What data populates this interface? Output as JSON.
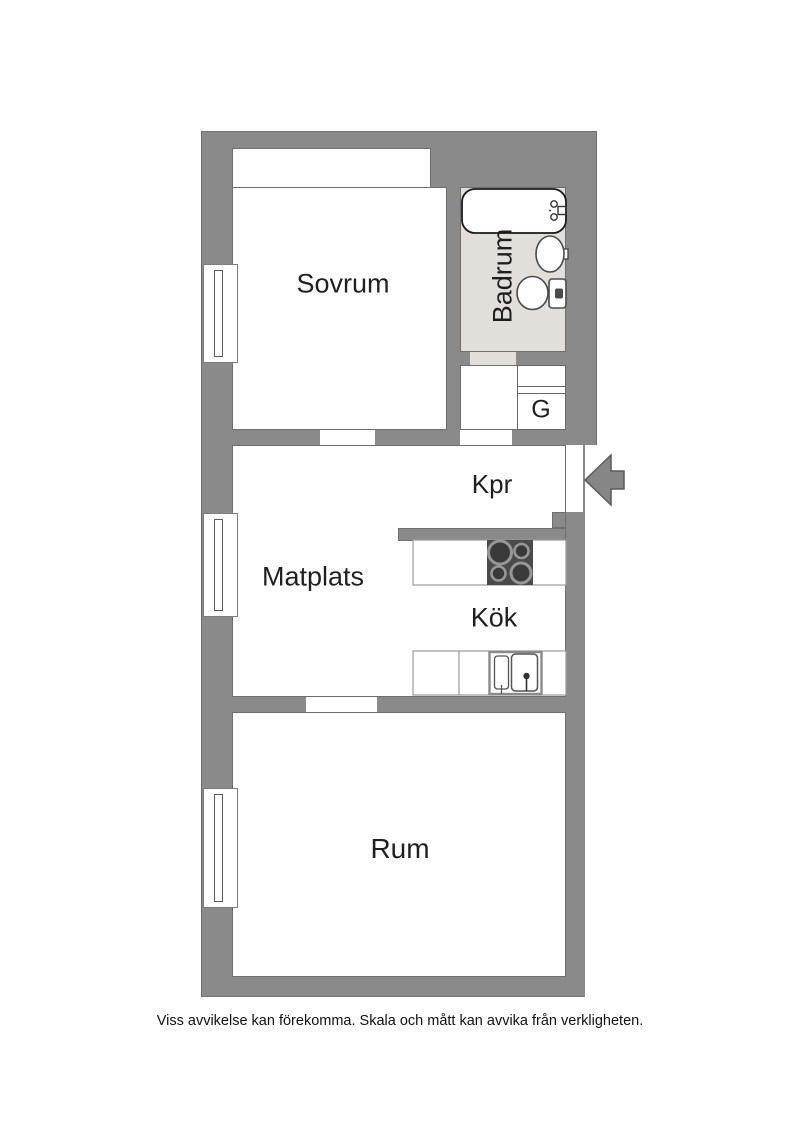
{
  "labels": {
    "sovrum": "Sovrum",
    "badrum": "Badrum",
    "garderob": "G",
    "kpr": "Kpr",
    "matplats": "Matplats",
    "kok": "Kök",
    "rum": "Rum"
  },
  "caption": "Viss avvikelse kan förekomma. Skala och mått kan avvika från verkligheten.",
  "colors": {
    "wall": "#8a8a8a",
    "wall_outline": "#6e6e6e",
    "bathroom_floor": "#e2dfda",
    "stove": "#4a4a4a",
    "background": "#ffffff"
  },
  "fixtures": {
    "bathtub": "bathtub",
    "washbasin": "oval-sink",
    "toilet": "toilet",
    "stove": "4-burner-hob",
    "kitchen_sink": "double-sink",
    "entry": "entry-arrow",
    "windows": "double-line-window"
  }
}
